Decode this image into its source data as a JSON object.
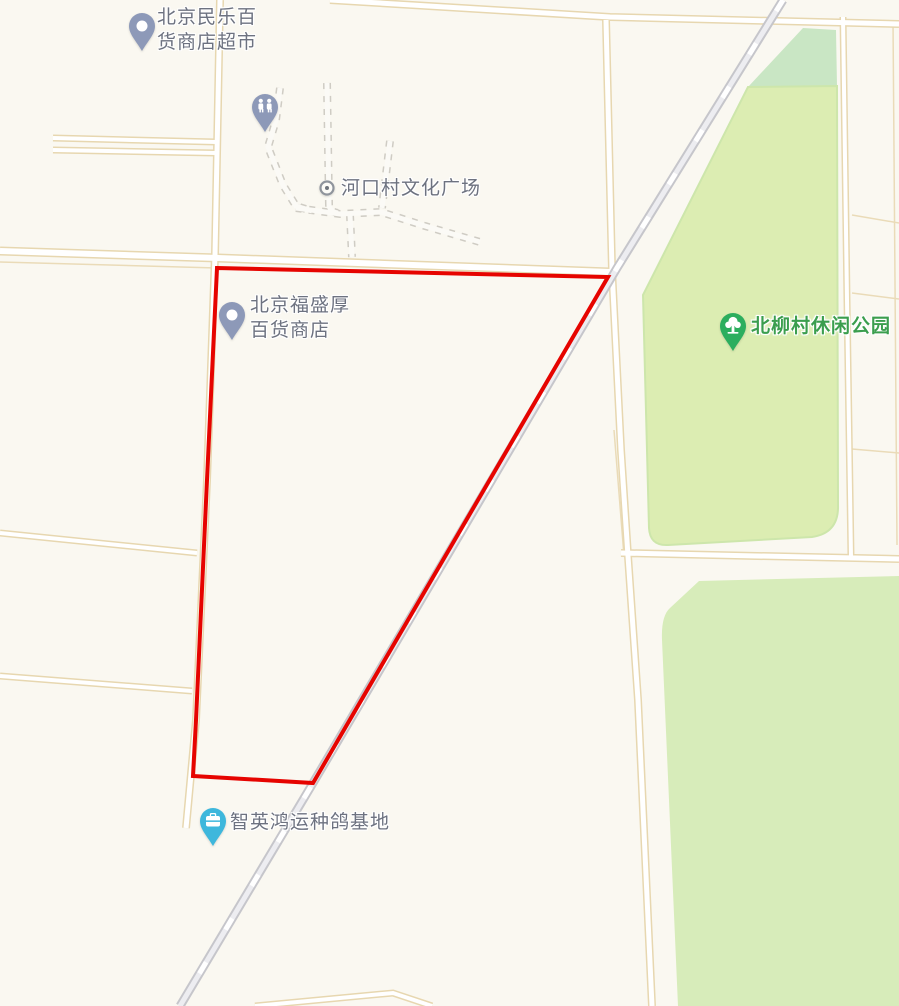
{
  "map": {
    "type": "street-map",
    "background_color": "#faf8f1",
    "selection_outline_color": "#e60400",
    "road_fill_color": "#ffffff",
    "road_casing_color": "#e7d7b0",
    "railway_color": "#c6c6cb",
    "park_color_light": "#dcedb2",
    "park_color_dark": "#c9e6c4",
    "park_color_south": "#d7ecba",
    "pois": [
      {
        "id": "minle-supermarket",
        "label_line1": "北京民乐百",
        "label_line2": "货商店超市",
        "pin_color": "#8d99b8",
        "icon": "circle-pin"
      },
      {
        "id": "public-toilet",
        "pin_color": "#8d99b8",
        "icon": "restroom-pin"
      },
      {
        "id": "hekou-plaza",
        "label": "河口村文化广场",
        "icon": "plaza-dot",
        "icon_color": "#8f949c"
      },
      {
        "id": "fushenghou-store",
        "label_line1": "北京福盛厚",
        "label_line2": "百货商店",
        "pin_color": "#8d99b8",
        "icon": "circle-pin"
      },
      {
        "id": "beiliu-leisure-park",
        "label": "北柳村休闲公园",
        "pin_color": "#2cae5e",
        "label_color": "#3b9e4e",
        "icon": "tree-pin"
      },
      {
        "id": "pigeon-breeding-base",
        "label": "智英鸿运种鸽基地",
        "pin_color": "#3eb7dc",
        "icon": "briefcase-pin"
      }
    ]
  }
}
